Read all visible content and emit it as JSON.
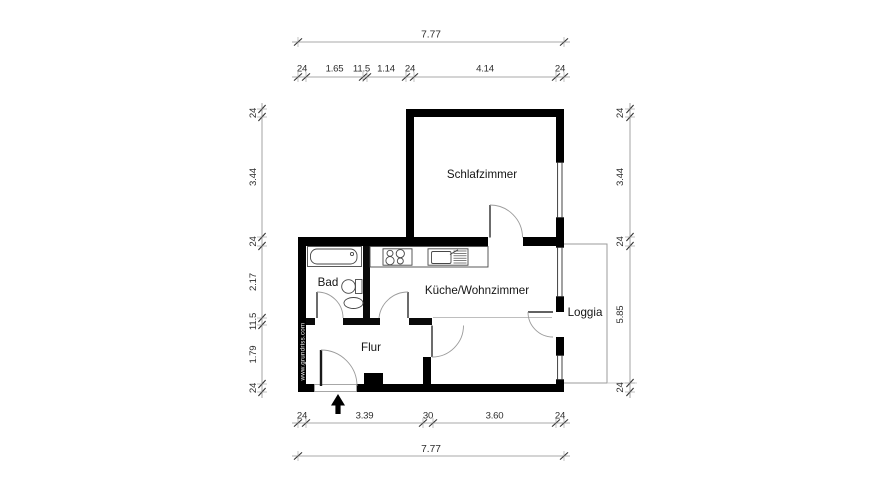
{
  "plan": {
    "rooms": {
      "schlafzimmer": "Schlafzimmer",
      "kueche_wohnzimmer": "Küche/Wohnzimmer",
      "bad": "Bad",
      "flur": "Flur",
      "loggia": "Loggia"
    },
    "watermark": "www.grundriss.com"
  },
  "dimensions": {
    "top_total": "7.77",
    "bottom_total": "7.77",
    "top_segments": [
      "24",
      "1.65",
      "11.5",
      "1.14",
      "24",
      "4.14",
      "24"
    ],
    "bottom_segments": [
      "24",
      "3.39",
      "30",
      "3.60",
      "24"
    ],
    "left_segments": [
      "24",
      "3.44",
      "24",
      "2.17",
      "11.5",
      "1.79",
      "24"
    ],
    "right_segments": [
      "24",
      "3.44",
      "24",
      "5.85",
      "24"
    ]
  },
  "colors": {
    "wall": "#000000",
    "background": "#ffffff",
    "dimension_text": "#2d2d2d"
  }
}
